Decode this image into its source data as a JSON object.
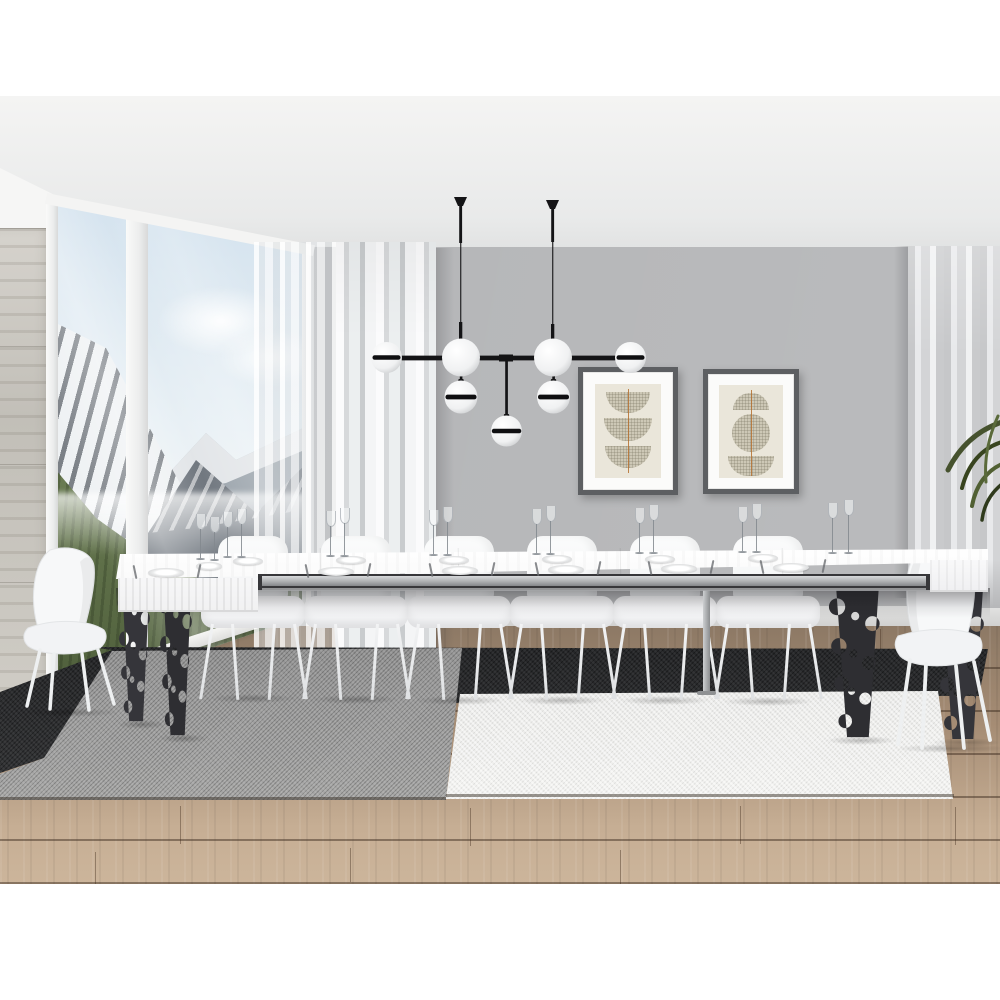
{
  "image_type": "interior product photograph (no text, no UI)",
  "scene": {
    "setting": "modern dining room with long white extendable dining table fully extended and set for a dinner",
    "key_objects": [
      "white extendable dining table with telescopic metal rails",
      "dark anthracite laser-cut table legs with circular cutouts",
      "white shell dining chairs on slim legs",
      "black-and-white globe chandelier with two ceiling rods",
      "two framed geometric half-circle art prints",
      "floor-to-ceiling window with snowy mountain valley view",
      "concrete pillar",
      "sheer white curtains and gray pleated curtain",
      "layered rugs in black, gray and off-white",
      "wood plank floor",
      "green plant fronds at right edge",
      "white plates, wine glasses and cutlery on the table"
    ],
    "counts": {
      "far_side_chairs": 6,
      "head_chairs": 2,
      "ornate_metal_table_legs": 4,
      "chandelier_globes_total": 7,
      "chandelier_banded_globes": 5,
      "chandelier_ceiling_rods": 2,
      "wall_art_frames": 2,
      "plates": 13,
      "wine_glasses": 16,
      "rug_panels": 3,
      "window_panes": 2
    },
    "art_prints": {
      "left": "three stacked downward half-circle halftone shapes with a thin vertical rust line",
      "right": "dome, circle and downward half-circle halftone shapes with a thin vertical rust line"
    },
    "window_view": "snow-capped alpine peaks, clouds and a green valley floor"
  },
  "palette": {
    "white": "#ffffff",
    "ceiling": "#f0f0ef",
    "wall": "#b6b7b9",
    "pillar": "#c9c6bf",
    "windowFrame": "#f3f3f1",
    "sky": "#d3e2ee",
    "rock": "#6e757d",
    "farRock": "#99a2aa",
    "snow": "#eef1f3",
    "valley": "#76885c",
    "valleyDark": "#4d5d3a",
    "sheer": "#f4f5f6",
    "curtain": "#cdcecf",
    "black": "#141416",
    "globe": "#fafbfc",
    "globeShade": "#c9cbcd",
    "frame": "#5d5f62",
    "mat": "#fbfbfa",
    "artBg": "#eae6da",
    "artShape": "#cdc8b6",
    "artLine": "#b5702f",
    "tableTop": "#fafafa",
    "tableFace": "#f1f1f2",
    "metal": "#a9abad",
    "recess": "#37373a",
    "legMetal": "#35353a",
    "chair": "#f6f7f8",
    "chairShade": "#e2e4e6",
    "rugDark": "#2b2c2e",
    "rugGray": "#9c9c9c",
    "rugWhite": "#ebebe9",
    "floorDark": "#8d7965",
    "floorMid": "#a58c74",
    "floorLight": "#c6ae94",
    "plant": "#46522e"
  }
}
